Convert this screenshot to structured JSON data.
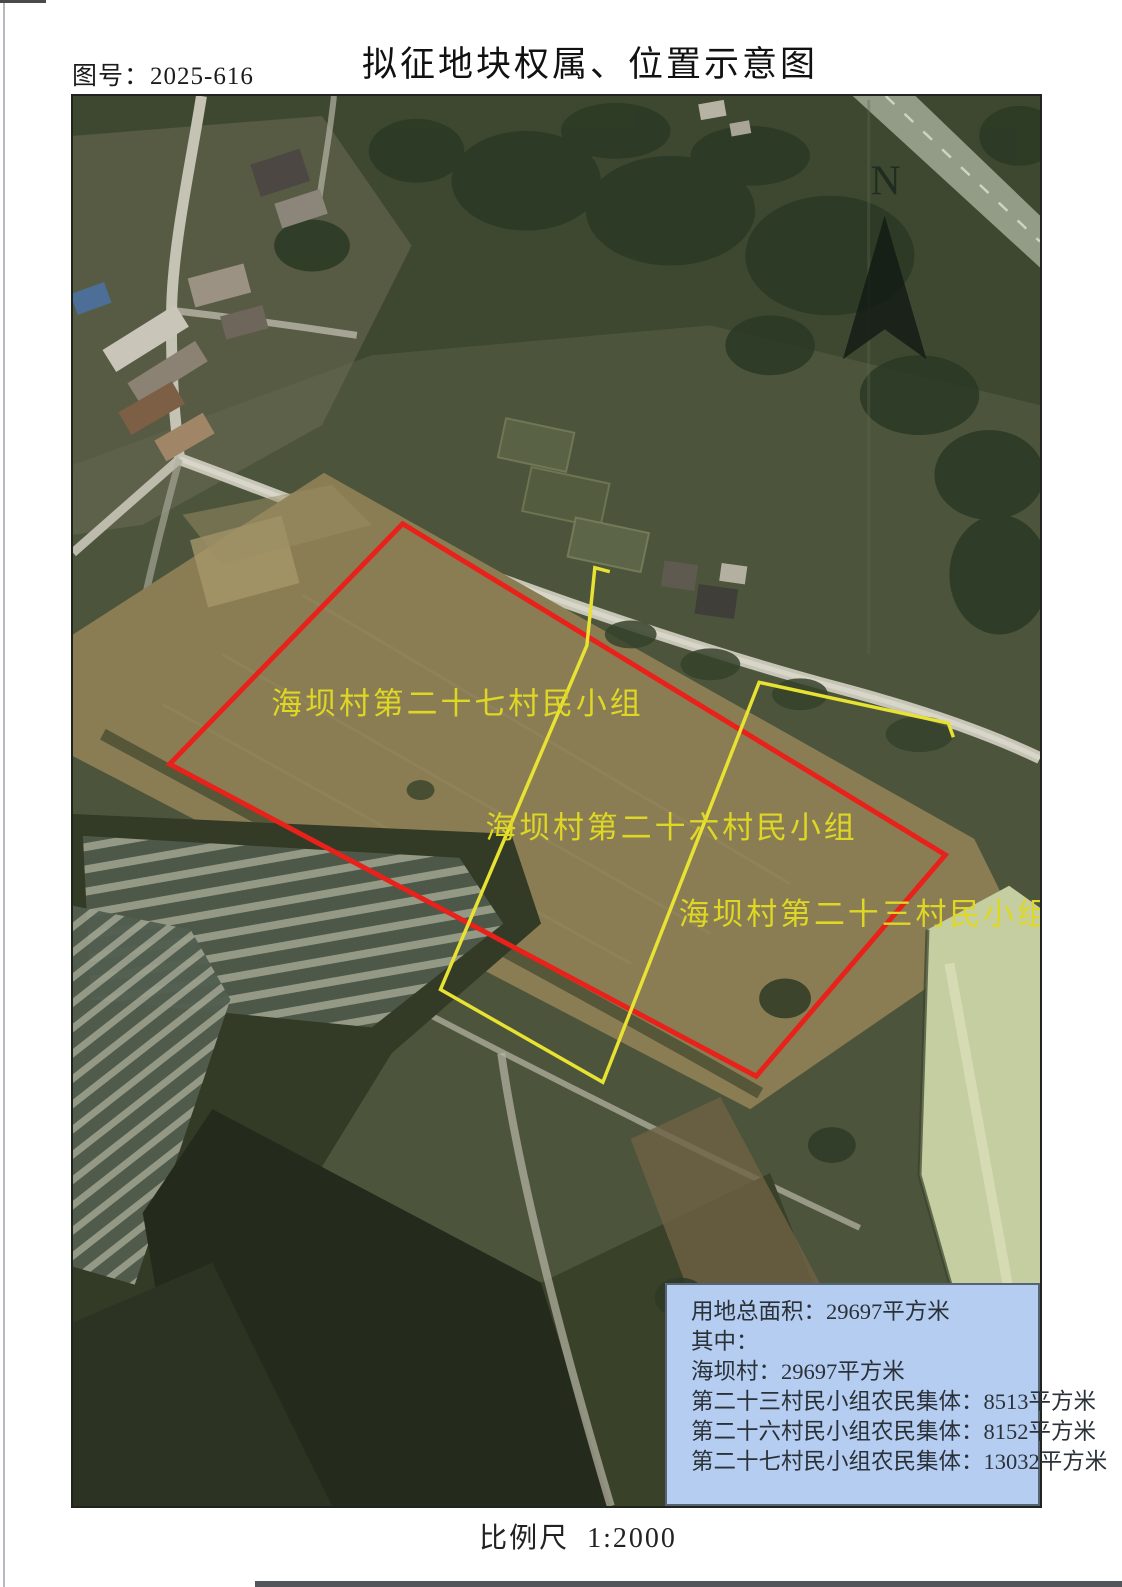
{
  "page": {
    "figure_number": "图号：2025-616",
    "title": "拟征地块权属、位置示意图",
    "scale_label": "比例尺  1:2000"
  },
  "map": {
    "north_label": "N",
    "icons": {
      "north_arrow": "solid-triangle-compass-pointer"
    },
    "parcel_labels": [
      "海坝村第二十七村民小组",
      "海坝村第二十六村民小组",
      "海坝村第二十三村民小组"
    ]
  },
  "info_box": {
    "lines": [
      "用地总面积：29697平方米",
      "其中：",
      "海坝村：29697平方米",
      "第二十三村民小组农民集体：8513平方米",
      "第二十六村民小组农民集体：8152平方米",
      "第二十七村民小组农民集体：13032平方米"
    ]
  },
  "colors": {
    "boundary_red": "#e8211b",
    "boundary_yellow": "#e8e233",
    "parcel_label_yellow": "#ded723",
    "info_box_bg": "#b5cdf0",
    "info_box_text": "#2a3138"
  }
}
